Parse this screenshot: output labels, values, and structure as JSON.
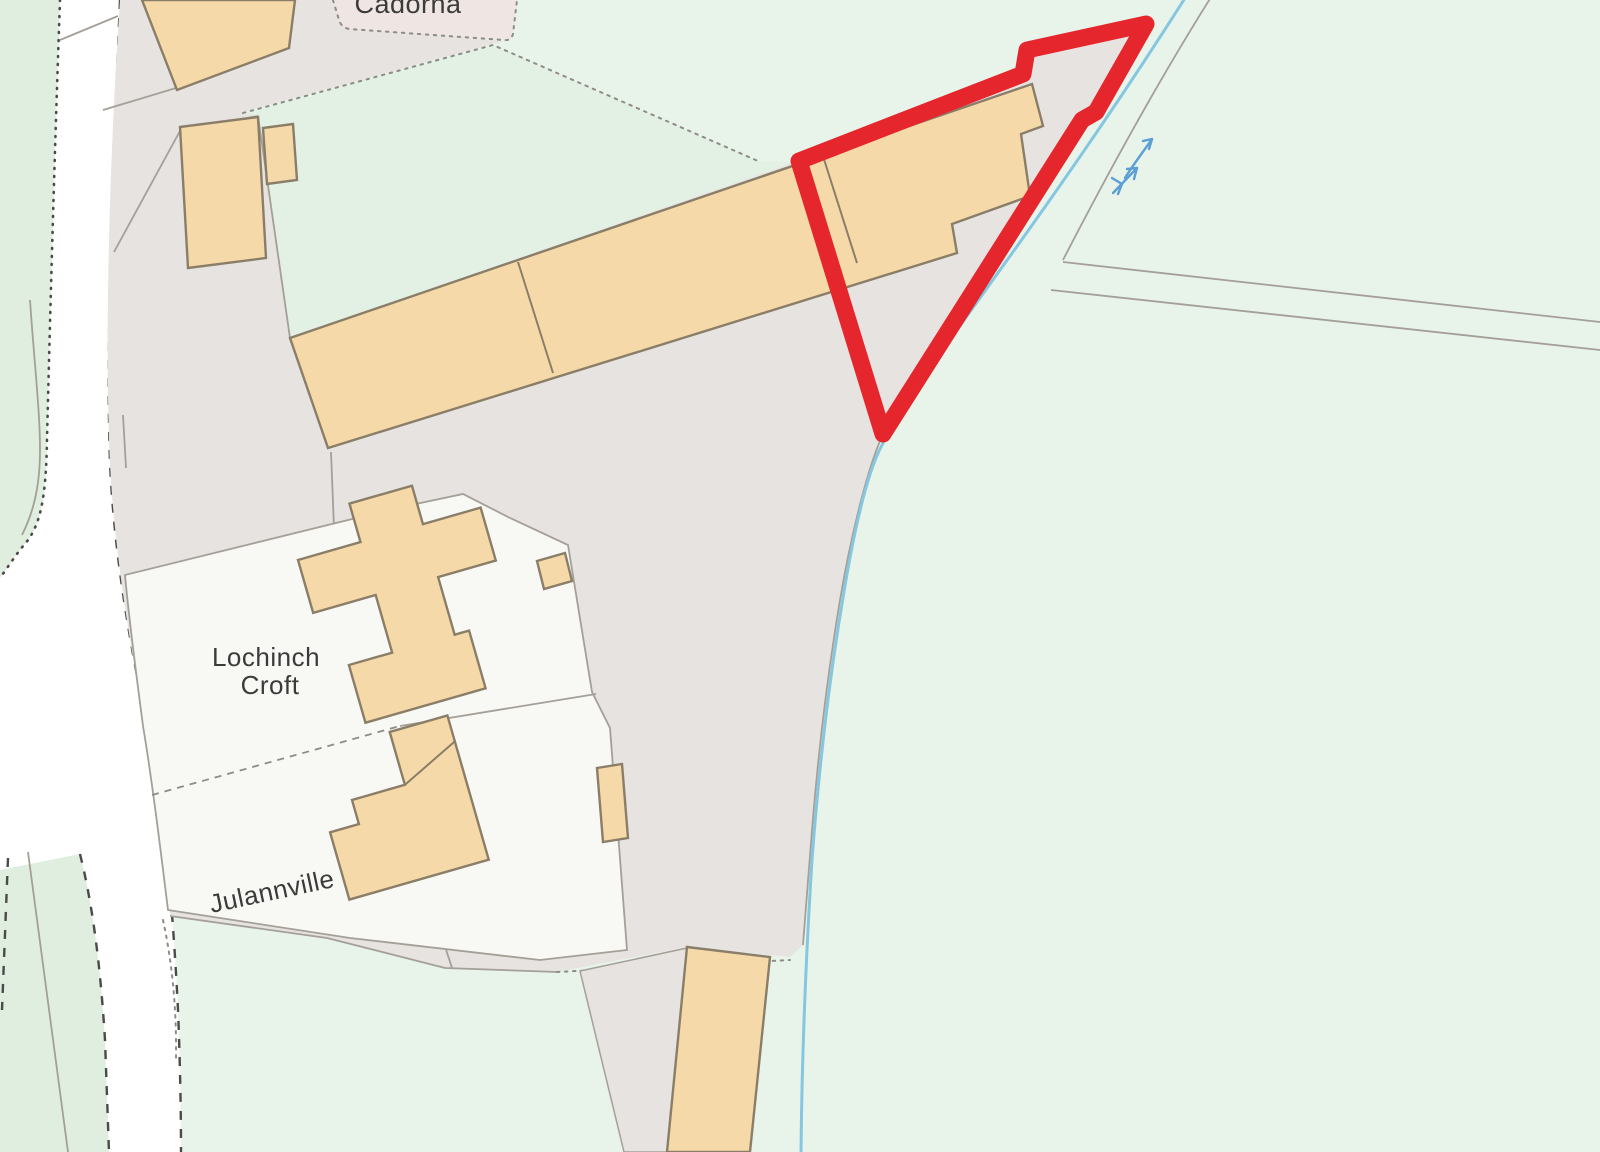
{
  "map": {
    "labels": {
      "cadorna": "Cadorna",
      "croft_line1": "Lochinch",
      "croft_line2": "Croft",
      "julannville": "Julannville"
    },
    "icons": {
      "stream_flow_arrow": "flow-direction-arrow",
      "stream_flow_glyph": "watercourse-flow-glyph"
    },
    "colors": {
      "field_green": "#e8f4ea",
      "strip_green": "#e3f0e4",
      "verge_green": "#dfeede",
      "yard_grey": "#e6e3e0",
      "plot_pink": "#efe6e4",
      "road_white": "#ffffff",
      "plot_white": "#f8f8f5",
      "building_fill": "#f6d9a8",
      "building_stroke": "#8a7e68",
      "boundary_red": "#e5262c",
      "stream_blue": "#85c6e0",
      "arrow_blue": "#5b9fd4",
      "dash_dark": "#4a4a48",
      "dash_light": "#8f8c86",
      "parcel_line": "#a49f97",
      "label_dark": "#3b3b3b"
    }
  }
}
